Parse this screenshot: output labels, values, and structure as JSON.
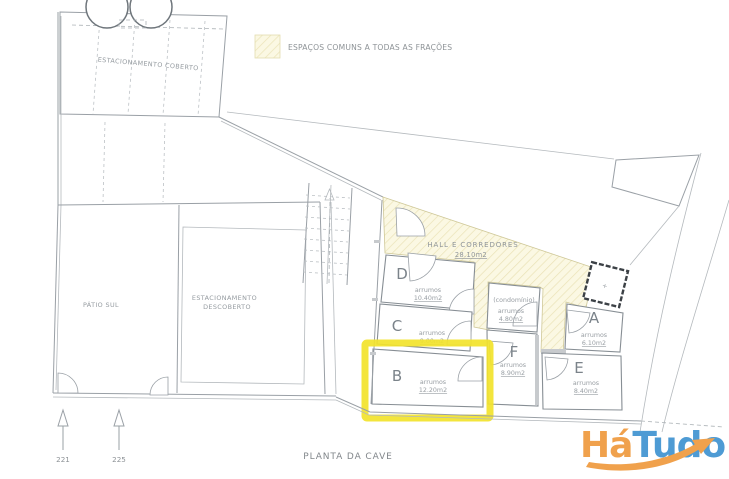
{
  "legend": {
    "label": "ESPAÇOS COMUNS A TODAS AS FRAÇÕES"
  },
  "site": {
    "estacionamento_coberto": "ESTACIONAMENTO COBERTO",
    "patio_sul": "PÁTIO SUL",
    "estacionamento_descoberto_line1": "ESTACIONAMENTO",
    "estacionamento_descoberto_line2": "DESCOBERTO"
  },
  "hall": {
    "name": "HALL E CORREDORES",
    "area": "28.10m2"
  },
  "rooms": {
    "d": {
      "letter": "D",
      "label": "arrumos",
      "area": "10.40m2"
    },
    "c": {
      "letter": "C",
      "label": "arrumos",
      "area": "9.00m2"
    },
    "b": {
      "letter": "B",
      "label": "arrumos",
      "area": "12.20m2",
      "highlighted": true
    },
    "f": {
      "letter": "F",
      "label": "arrumos",
      "area": "8.90m2"
    },
    "a": {
      "letter": "A",
      "label": "arrumos",
      "area": "6.10m2"
    },
    "e": {
      "letter": "E",
      "label": "arrumos",
      "area": "8.40m2"
    },
    "condominio": {
      "name": "(condomínio)",
      "label": "arrumos",
      "area": "4.80m2"
    }
  },
  "elevator": {
    "mark": "+"
  },
  "plan": {
    "title": "PLANTA DA CAVE",
    "marker_left": "221",
    "marker_right": "225"
  },
  "highlight": {
    "room": "B",
    "color": "#F2E32B"
  },
  "colors": {
    "hatch_fill": "#FBF8E3",
    "hatch_line": "#EAE2B6",
    "drawing_line": "#9AA0A6",
    "logo_orange": "#F0A14C",
    "logo_blue": "#4E9BD4"
  },
  "logo": {
    "part1": "Há",
    "part2": "Tudo"
  }
}
